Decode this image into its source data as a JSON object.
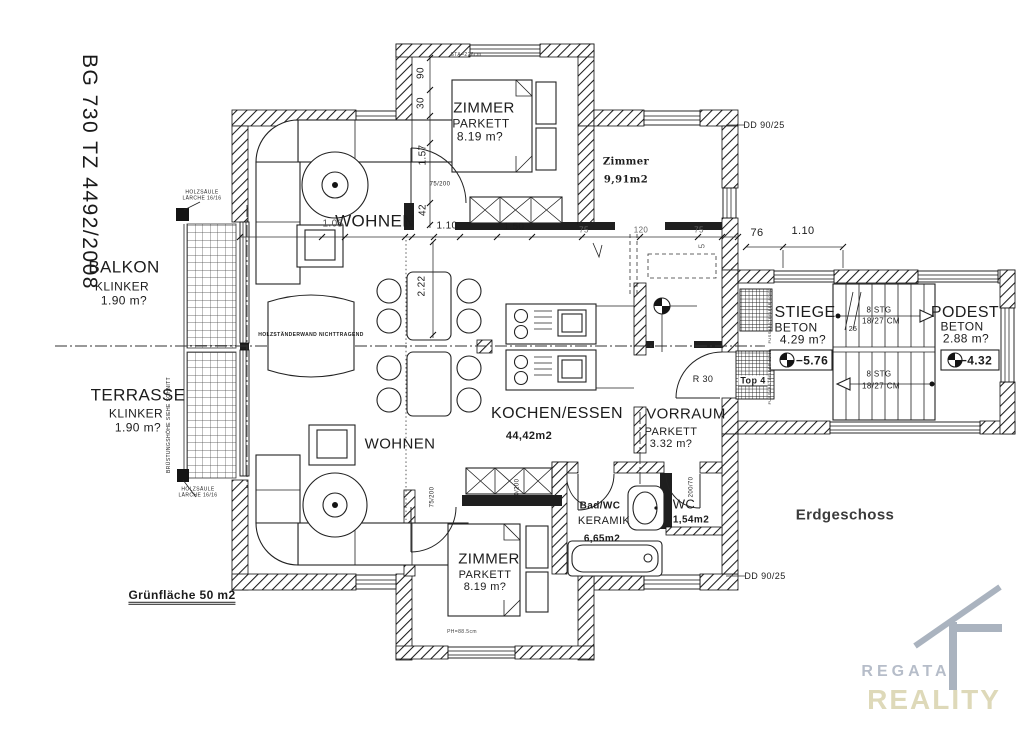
{
  "meta": {
    "drawing_number": "BG 730 TZ 4492/2008",
    "floor": "Erdgeschoss"
  },
  "logo": {
    "line1": "REGATA",
    "line2": "REALITY",
    "color1": "#b6bdc9",
    "color2": "#ded9b9"
  },
  "labels": [
    {
      "id": "balkon-title",
      "text": "BALKON",
      "x": 124,
      "y": 267,
      "size": 17
    },
    {
      "id": "balkon-material",
      "text": "KLINKER",
      "x": 122,
      "y": 287,
      "size": 12
    },
    {
      "id": "balkon-area",
      "text": "1.90 m?",
      "x": 124,
      "y": 301,
      "size": 12
    },
    {
      "id": "terrasse-title",
      "text": "TERRASSE",
      "x": 138,
      "y": 395,
      "size": 17
    },
    {
      "id": "terrasse-material",
      "text": "KLINKER",
      "x": 136,
      "y": 414,
      "size": 12
    },
    {
      "id": "terrasse-area",
      "text": "1.90 m?",
      "x": 138,
      "y": 428,
      "size": 12
    },
    {
      "id": "gruenflaeche-note",
      "text": "Grünfläche 50 m2",
      "x": 182,
      "y": 597,
      "size": 12,
      "bold": true,
      "ul": "double"
    },
    {
      "id": "holzsaeule-note-top",
      "text": "HOLZSÄULE\nLÄRCHE 16/16",
      "x": 202,
      "y": 196,
      "size": 5,
      "pre": true
    },
    {
      "id": "holzsaeule-note-bottom",
      "text": "HOLZSÄULE\nLÄRCHE 16/16",
      "x": 198,
      "y": 493,
      "size": 5,
      "pre": true
    },
    {
      "id": "bruestungshoehe-note",
      "text": "BRÜSTUNGSHÖHE SIEHE SCHNITT",
      "x": 170,
      "y": 425,
      "size": 5,
      "rot": -90
    },
    {
      "id": "wohnen-upper",
      "text": "WOHNEN",
      "x": 375,
      "y": 221,
      "size": 17
    },
    {
      "id": "wohnen-lower",
      "text": "WOHNEN",
      "x": 400,
      "y": 445,
      "size": 15
    },
    {
      "id": "zimmer-top-title",
      "text": "ZIMMER",
      "x": 484,
      "y": 109,
      "size": 15
    },
    {
      "id": "zimmer-top-material",
      "text": "PARKETT",
      "x": 481,
      "y": 124,
      "size": 12
    },
    {
      "id": "zimmer-top-area",
      "text": "8.19 m?",
      "x": 480,
      "y": 137,
      "size": 12
    },
    {
      "id": "zimmer-right-title",
      "text": "Zimmer",
      "x": 626,
      "y": 162,
      "size": 10,
      "bold": true,
      "family": "serif"
    },
    {
      "id": "zimmer-right-area",
      "text": "9,91m2",
      "x": 626,
      "y": 180,
      "size": 10,
      "bold": true,
      "family": "serif"
    },
    {
      "id": "kochen-title",
      "text": "KOCHEN/ESSEN",
      "x": 557,
      "y": 414,
      "size": 16
    },
    {
      "id": "kochen-area",
      "text": "44,42m2",
      "x": 529,
      "y": 436,
      "size": 11,
      "bold": true
    },
    {
      "id": "vorraum-title",
      "text": "VORRAUM",
      "x": 686,
      "y": 415,
      "size": 15
    },
    {
      "id": "vorraum-material",
      "text": "PARKETT",
      "x": 671,
      "y": 432,
      "size": 11
    },
    {
      "id": "vorraum-area",
      "text": "3.32 m?",
      "x": 671,
      "y": 444,
      "size": 11
    },
    {
      "id": "badwc-title",
      "text": "Bad/WC",
      "x": 600,
      "y": 506,
      "size": 10,
      "bold": true
    },
    {
      "id": "badwc-material",
      "text": "KERAMIK",
      "x": 604,
      "y": 521,
      "size": 11
    },
    {
      "id": "badwc-area",
      "text": "6,65m2",
      "x": 602,
      "y": 539,
      "size": 10,
      "bold": true
    },
    {
      "id": "wc-title",
      "text": "WC",
      "x": 684,
      "y": 505,
      "size": 13
    },
    {
      "id": "wc-area",
      "text": "1,54m2",
      "x": 691,
      "y": 520,
      "size": 10,
      "bold": true
    },
    {
      "id": "zimmer-bottom-title",
      "text": "ZIMMER",
      "x": 489,
      "y": 560,
      "size": 15
    },
    {
      "id": "zimmer-bottom-material",
      "text": "PARKETT",
      "x": 485,
      "y": 575,
      "size": 11
    },
    {
      "id": "zimmer-bottom-area",
      "text": "8.19 m?",
      "x": 485,
      "y": 587,
      "size": 11
    },
    {
      "id": "stiege-title",
      "text": "STIEGE",
      "x": 805,
      "y": 313,
      "size": 16
    },
    {
      "id": "stiege-material",
      "text": "BETON",
      "x": 796,
      "y": 328,
      "size": 12
    },
    {
      "id": "stiege-area",
      "text": "4.29 m?",
      "x": 803,
      "y": 340,
      "size": 12
    },
    {
      "id": "stiege-level",
      "text": "−5.76",
      "x": 812,
      "y": 361,
      "size": 12,
      "bold": true
    },
    {
      "id": "podest-title",
      "text": "PODEST",
      "x": 965,
      "y": 313,
      "size": 16
    },
    {
      "id": "podest-material",
      "text": "BETON",
      "x": 962,
      "y": 327,
      "size": 12
    },
    {
      "id": "podest-area",
      "text": "2.88 m?",
      "x": 966,
      "y": 339,
      "size": 12
    },
    {
      "id": "podest-level",
      "text": "−4.32",
      "x": 976,
      "y": 361,
      "size": 12,
      "bold": true
    },
    {
      "id": "stairs-upper-count",
      "text": "8 STG",
      "x": 879,
      "y": 311,
      "size": 8
    },
    {
      "id": "stairs-upper-dim",
      "text": "18/27 CM",
      "x": 881,
      "y": 322,
      "size": 8
    },
    {
      "id": "stairs-lower-count",
      "text": "8 STG",
      "x": 879,
      "y": 375,
      "size": 8
    },
    {
      "id": "stairs-lower-dim",
      "text": "18/27 CM",
      "x": 881,
      "y": 387,
      "size": 8
    },
    {
      "id": "top4-label",
      "text": "Top 4",
      "x": 753,
      "y": 381,
      "size": 9,
      "bold": true,
      "ul": "single",
      "bg": "#fff"
    },
    {
      "id": "fussabstreifer-upper",
      "text": "FUSSABSTREIFER 80/60",
      "x": 770,
      "y": 316,
      "size": 4,
      "rot": -90
    },
    {
      "id": "fussabstreifer-lower",
      "text": "FUSSABSTREIFER 80/60",
      "x": 770,
      "y": 377,
      "size": 4,
      "rot": -90
    },
    {
      "id": "door-r30",
      "text": "R 30",
      "x": 703,
      "y": 379,
      "size": 9
    },
    {
      "id": "dd-top",
      "text": "DD 90/25",
      "x": 764,
      "y": 125,
      "size": 9
    },
    {
      "id": "dd-bottom",
      "text": "DD 90/25",
      "x": 765,
      "y": 576,
      "size": 9
    },
    {
      "id": "floor-title",
      "text": "Erdgeschoss",
      "x": 845,
      "y": 516,
      "size": 15,
      "bold": true,
      "color": "#3b3b3b"
    },
    {
      "id": "dim-90",
      "text": "90",
      "x": 421,
      "y": 73,
      "size": 10,
      "rot": -90
    },
    {
      "id": "dim-30",
      "text": "30",
      "x": 421,
      "y": 103,
      "size": 10,
      "rot": -90
    },
    {
      "id": "dim-1-57",
      "text": "1.57",
      "x": 423,
      "y": 155,
      "size": 10,
      "rot": -90
    },
    {
      "id": "dim-75-200-top",
      "text": "75/200",
      "x": 440,
      "y": 185,
      "size": 6
    },
    {
      "id": "dim-42",
      "text": "42",
      "x": 423,
      "y": 210,
      "size": 10,
      "rot": -90
    },
    {
      "id": "dim-1-05",
      "text": "1.05",
      "x": 333,
      "y": 224,
      "size": 10,
      "color": "#555"
    },
    {
      "id": "dim-10",
      "text": "10",
      "x": 409,
      "y": 225,
      "size": 8
    },
    {
      "id": "dim-1-10",
      "text": "1.10",
      "x": 447,
      "y": 226,
      "size": 10
    },
    {
      "id": "dim-1-50",
      "text": "1.50",
      "x": 514,
      "y": 227,
      "size": 10
    },
    {
      "id": "dim-75-a",
      "text": "75",
      "x": 584,
      "y": 231,
      "size": 8,
      "color": "#666"
    },
    {
      "id": "dim-120",
      "text": "120",
      "x": 641,
      "y": 231,
      "size": 8,
      "color": "#666"
    },
    {
      "id": "dim-75-b",
      "text": "75",
      "x": 699,
      "y": 231,
      "size": 8,
      "color": "#666"
    },
    {
      "id": "dim-5",
      "text": "5",
      "x": 703,
      "y": 246,
      "size": 8,
      "rot": -90,
      "color": "#666"
    },
    {
      "id": "dim-2-22",
      "text": "2.22",
      "x": 422,
      "y": 286,
      "size": 10,
      "rot": -90
    },
    {
      "id": "dim-76",
      "text": "76",
      "x": 757,
      "y": 233,
      "size": 11
    },
    {
      "id": "dim-1-10-b",
      "text": "1.10",
      "x": 803,
      "y": 231,
      "size": 11
    },
    {
      "id": "dim-75-200-lower",
      "text": "75/200",
      "x": 433,
      "y": 497,
      "size": 6,
      "rot": -90
    },
    {
      "id": "dim-70-200-bad",
      "text": "70/200",
      "x": 518,
      "y": 489,
      "size": 6,
      "rot": -90
    },
    {
      "id": "dim-200-70-wc",
      "text": "200/70",
      "x": 692,
      "y": 487,
      "size": 6,
      "rot": -90
    },
    {
      "id": "dim-25",
      "text": "25",
      "x": 853,
      "y": 330,
      "size": 7
    },
    {
      "id": "note-sta",
      "text": "STA=226cm",
      "x": 466,
      "y": 56,
      "size": 5,
      "color": "#444"
    },
    {
      "id": "note-ph",
      "text": "PH=88.5cm",
      "x": 462,
      "y": 633,
      "size": 5,
      "color": "#444"
    },
    {
      "id": "holzstaenderwand-note",
      "text": "HOLZSTÄNDERWAND NICHTTRAGEND",
      "x": 311,
      "y": 336,
      "size": 5,
      "bold": true
    }
  ]
}
